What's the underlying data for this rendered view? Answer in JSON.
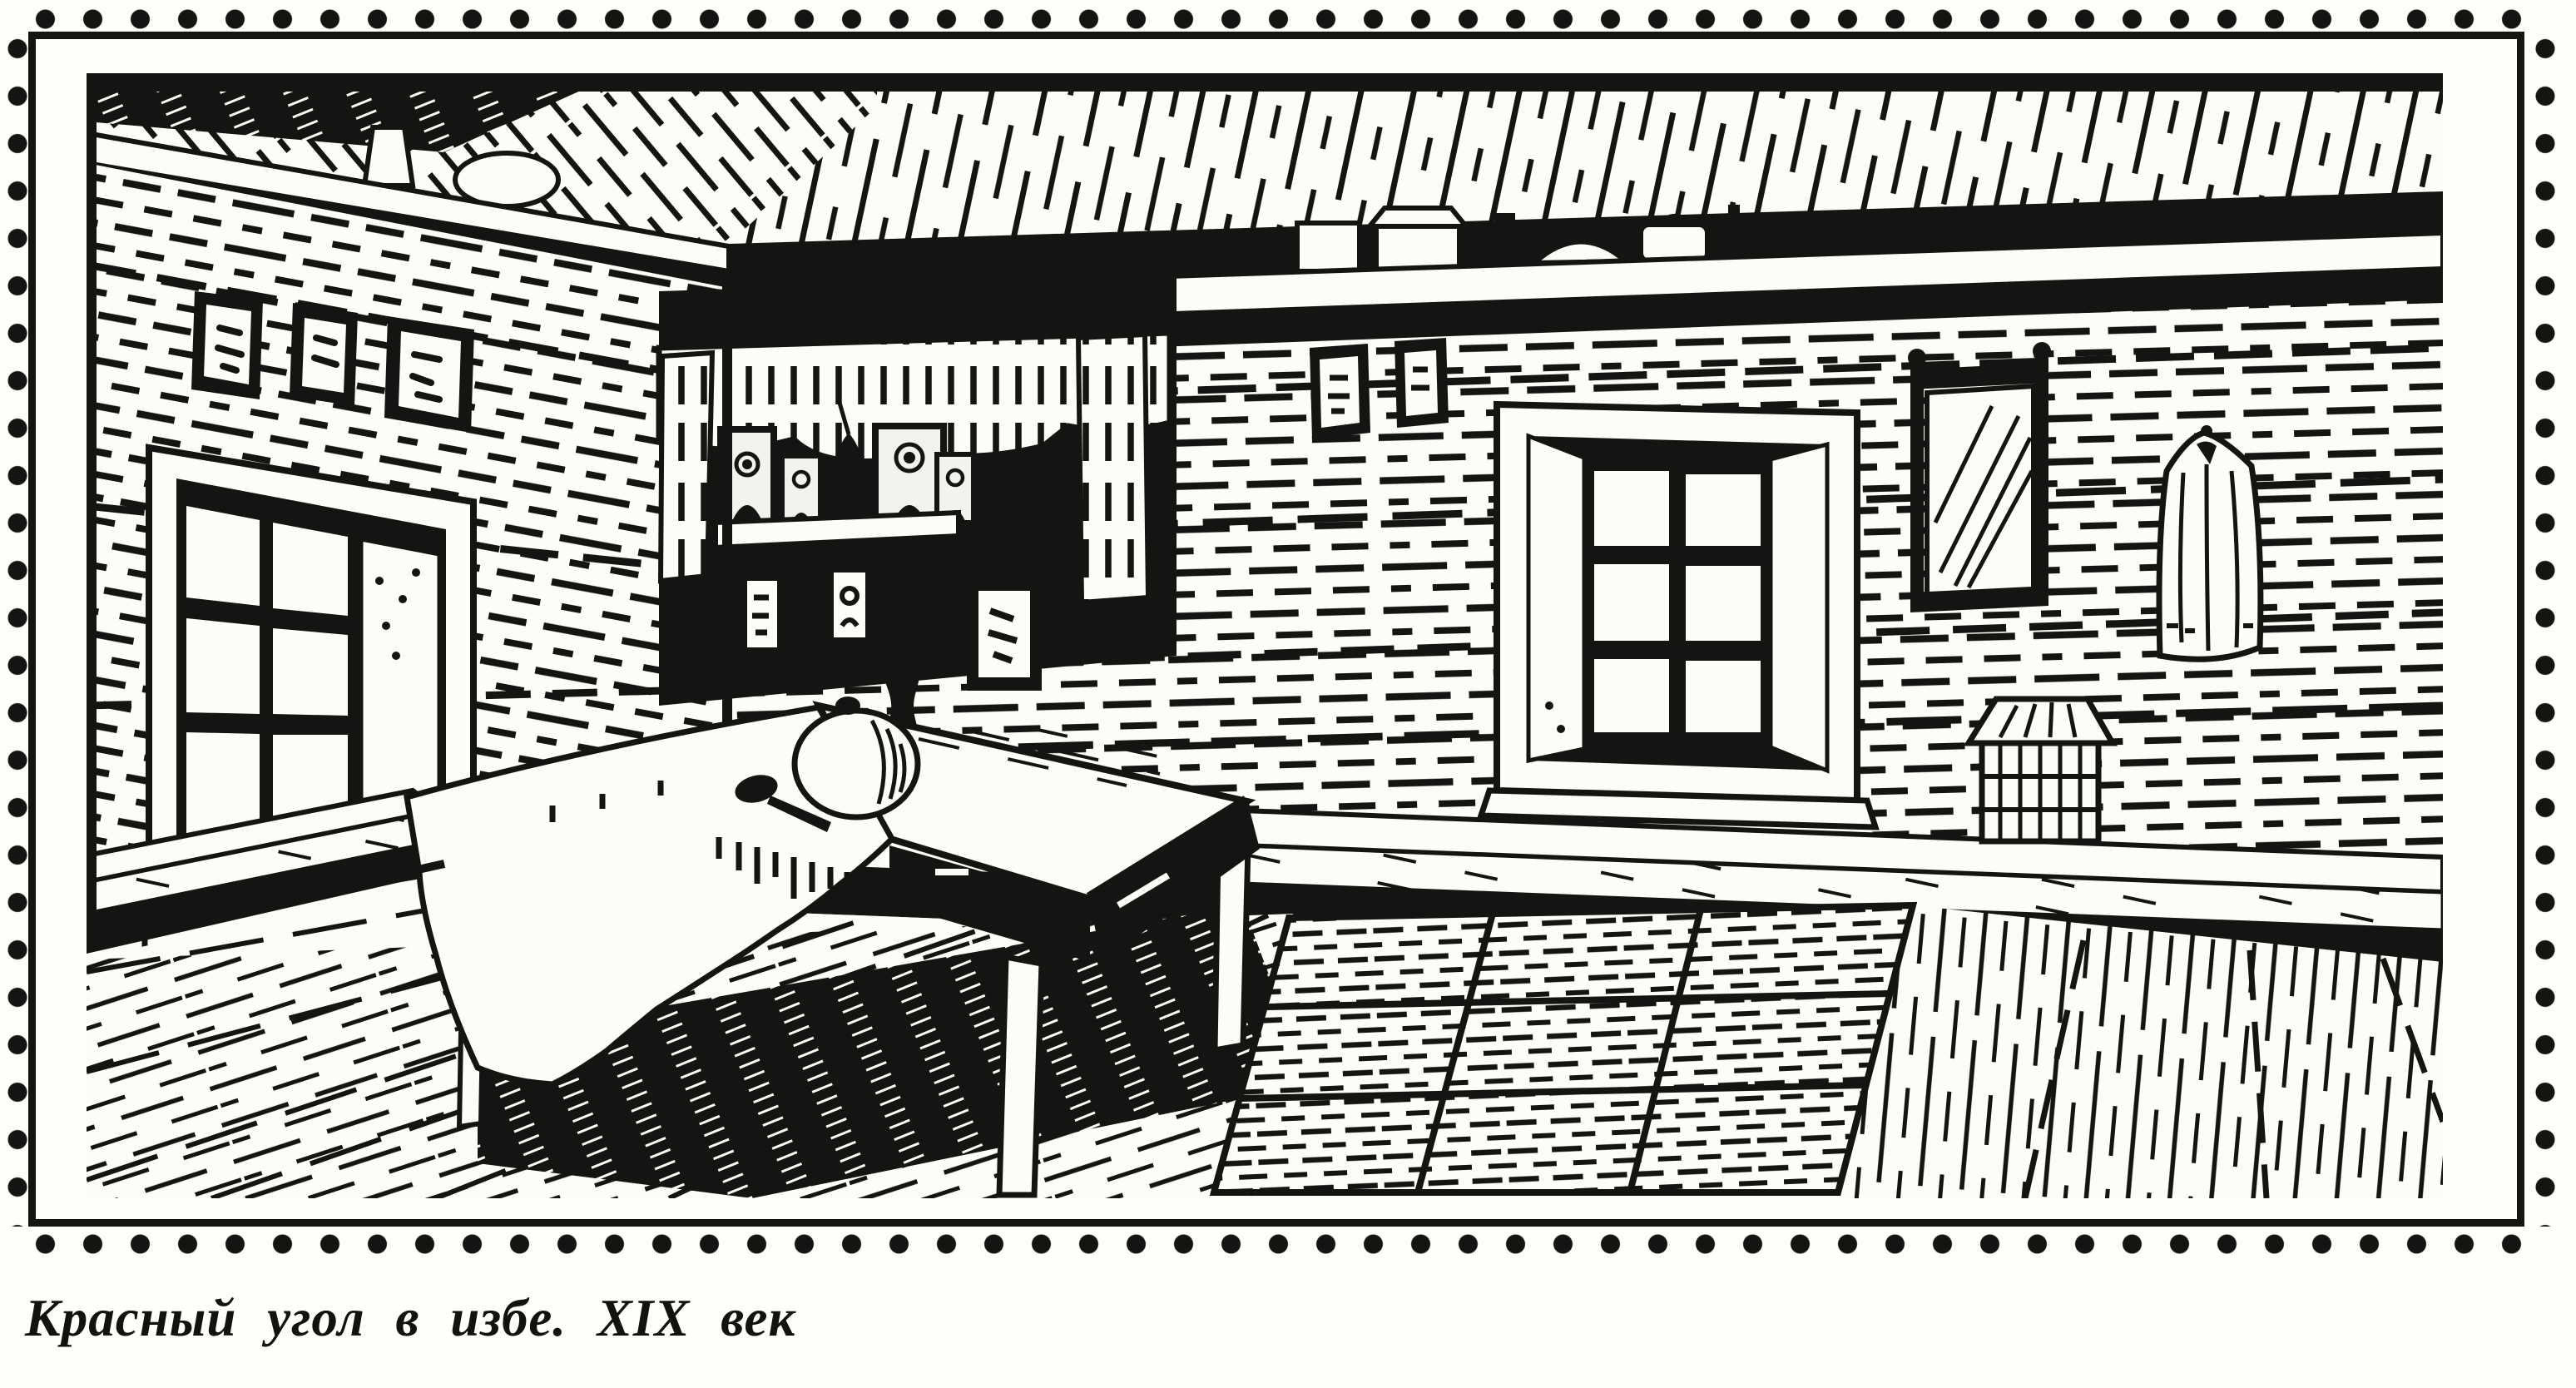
{
  "caption": {
    "text": "Красный угол в избе. XIX век"
  },
  "figure": {
    "alt": "Black-ink engraving of a 19th-century Russian izba interior: the icon (red) corner with a curtained icon shelf and hanging lamp, a table with a white cloth, round loaf and spoon, benches along log walls, a six-pane window in each wall, a crockery shelf under the ceiling, small framed prints, a mirror, a hanging coat, a wicker chest and a plank floor with a rag rug",
    "style": "woodcut engraving, black ink on paper"
  },
  "colors": {
    "ink": "#161412",
    "paper": "#fffefb"
  }
}
